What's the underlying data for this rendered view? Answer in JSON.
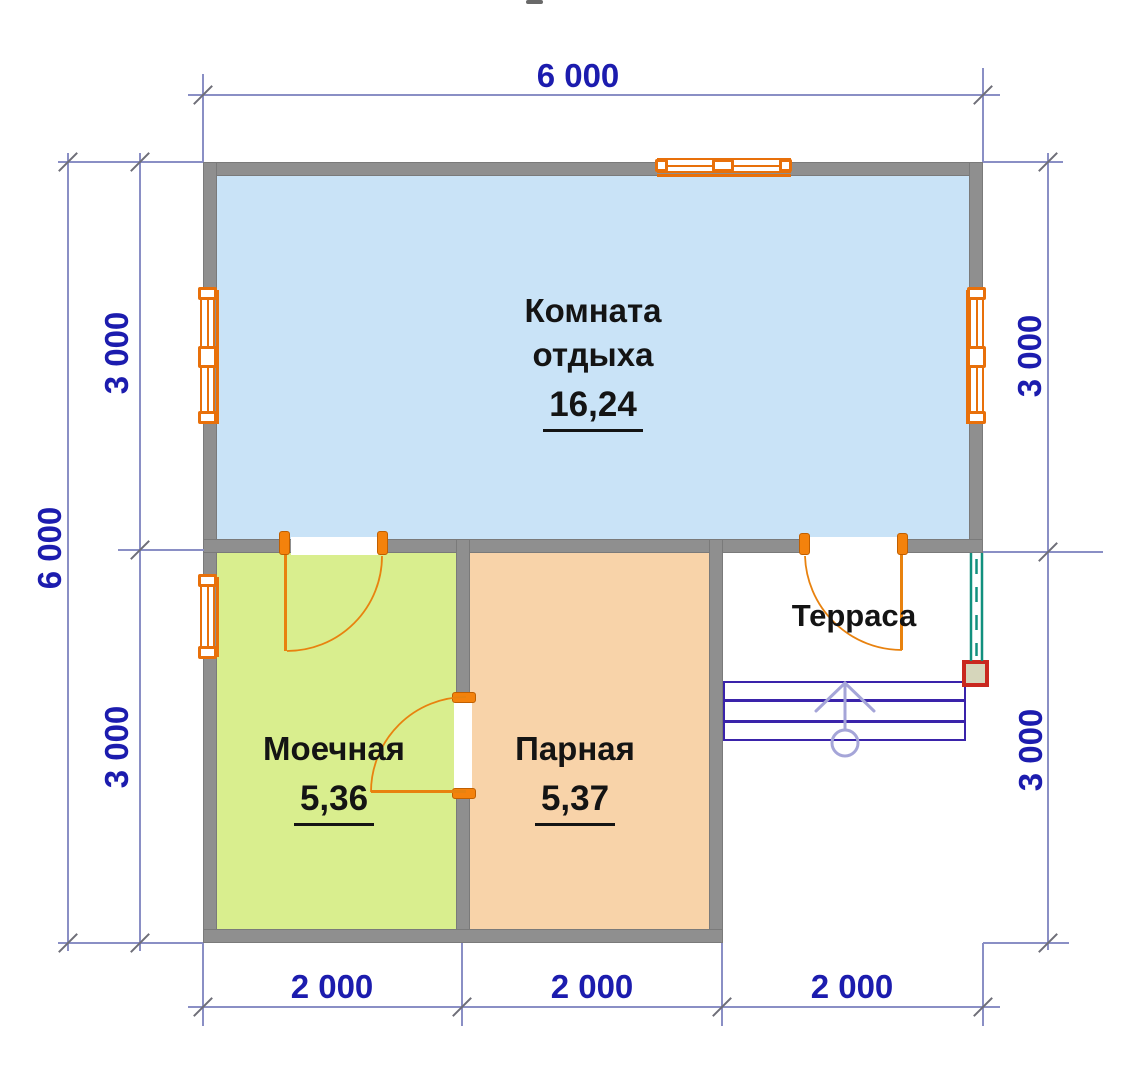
{
  "dimensions": {
    "top": "6 000",
    "left_total": "6 000",
    "left_upper": "3 000",
    "left_lower": "3 000",
    "right_upper": "3 000",
    "right_lower": "3 000",
    "bottom": [
      "2 000",
      "2 000",
      "2 000"
    ]
  },
  "rooms": {
    "rest": {
      "line1": "Комната",
      "line2": "отдыха",
      "area": "16,24"
    },
    "wash": {
      "name": "Моечная",
      "area": "5,36"
    },
    "steam": {
      "name": "Парная",
      "area": "5,37"
    },
    "terrace": {
      "name": "Терраса"
    }
  },
  "colors": {
    "wall": "#8f8f8f",
    "room-rest": "#c9e3f7",
    "room-wash": "#d9ee8e",
    "room-steam": "#f8d3a9",
    "frame-orange": "#e8700a",
    "jamb-orange": "#f4820c",
    "leaf-orange": "#e8820f",
    "dim-line": "#8a8fc5",
    "dim-text": "#1c1cae",
    "tick": "#6e6e78",
    "stairs": "#3a23aa",
    "stairs-arrow": "#a5a5d8",
    "railing": "#12907e",
    "column-red": "#c9281f",
    "column-fill": "#d6d6bb",
    "label": "#141414"
  }
}
